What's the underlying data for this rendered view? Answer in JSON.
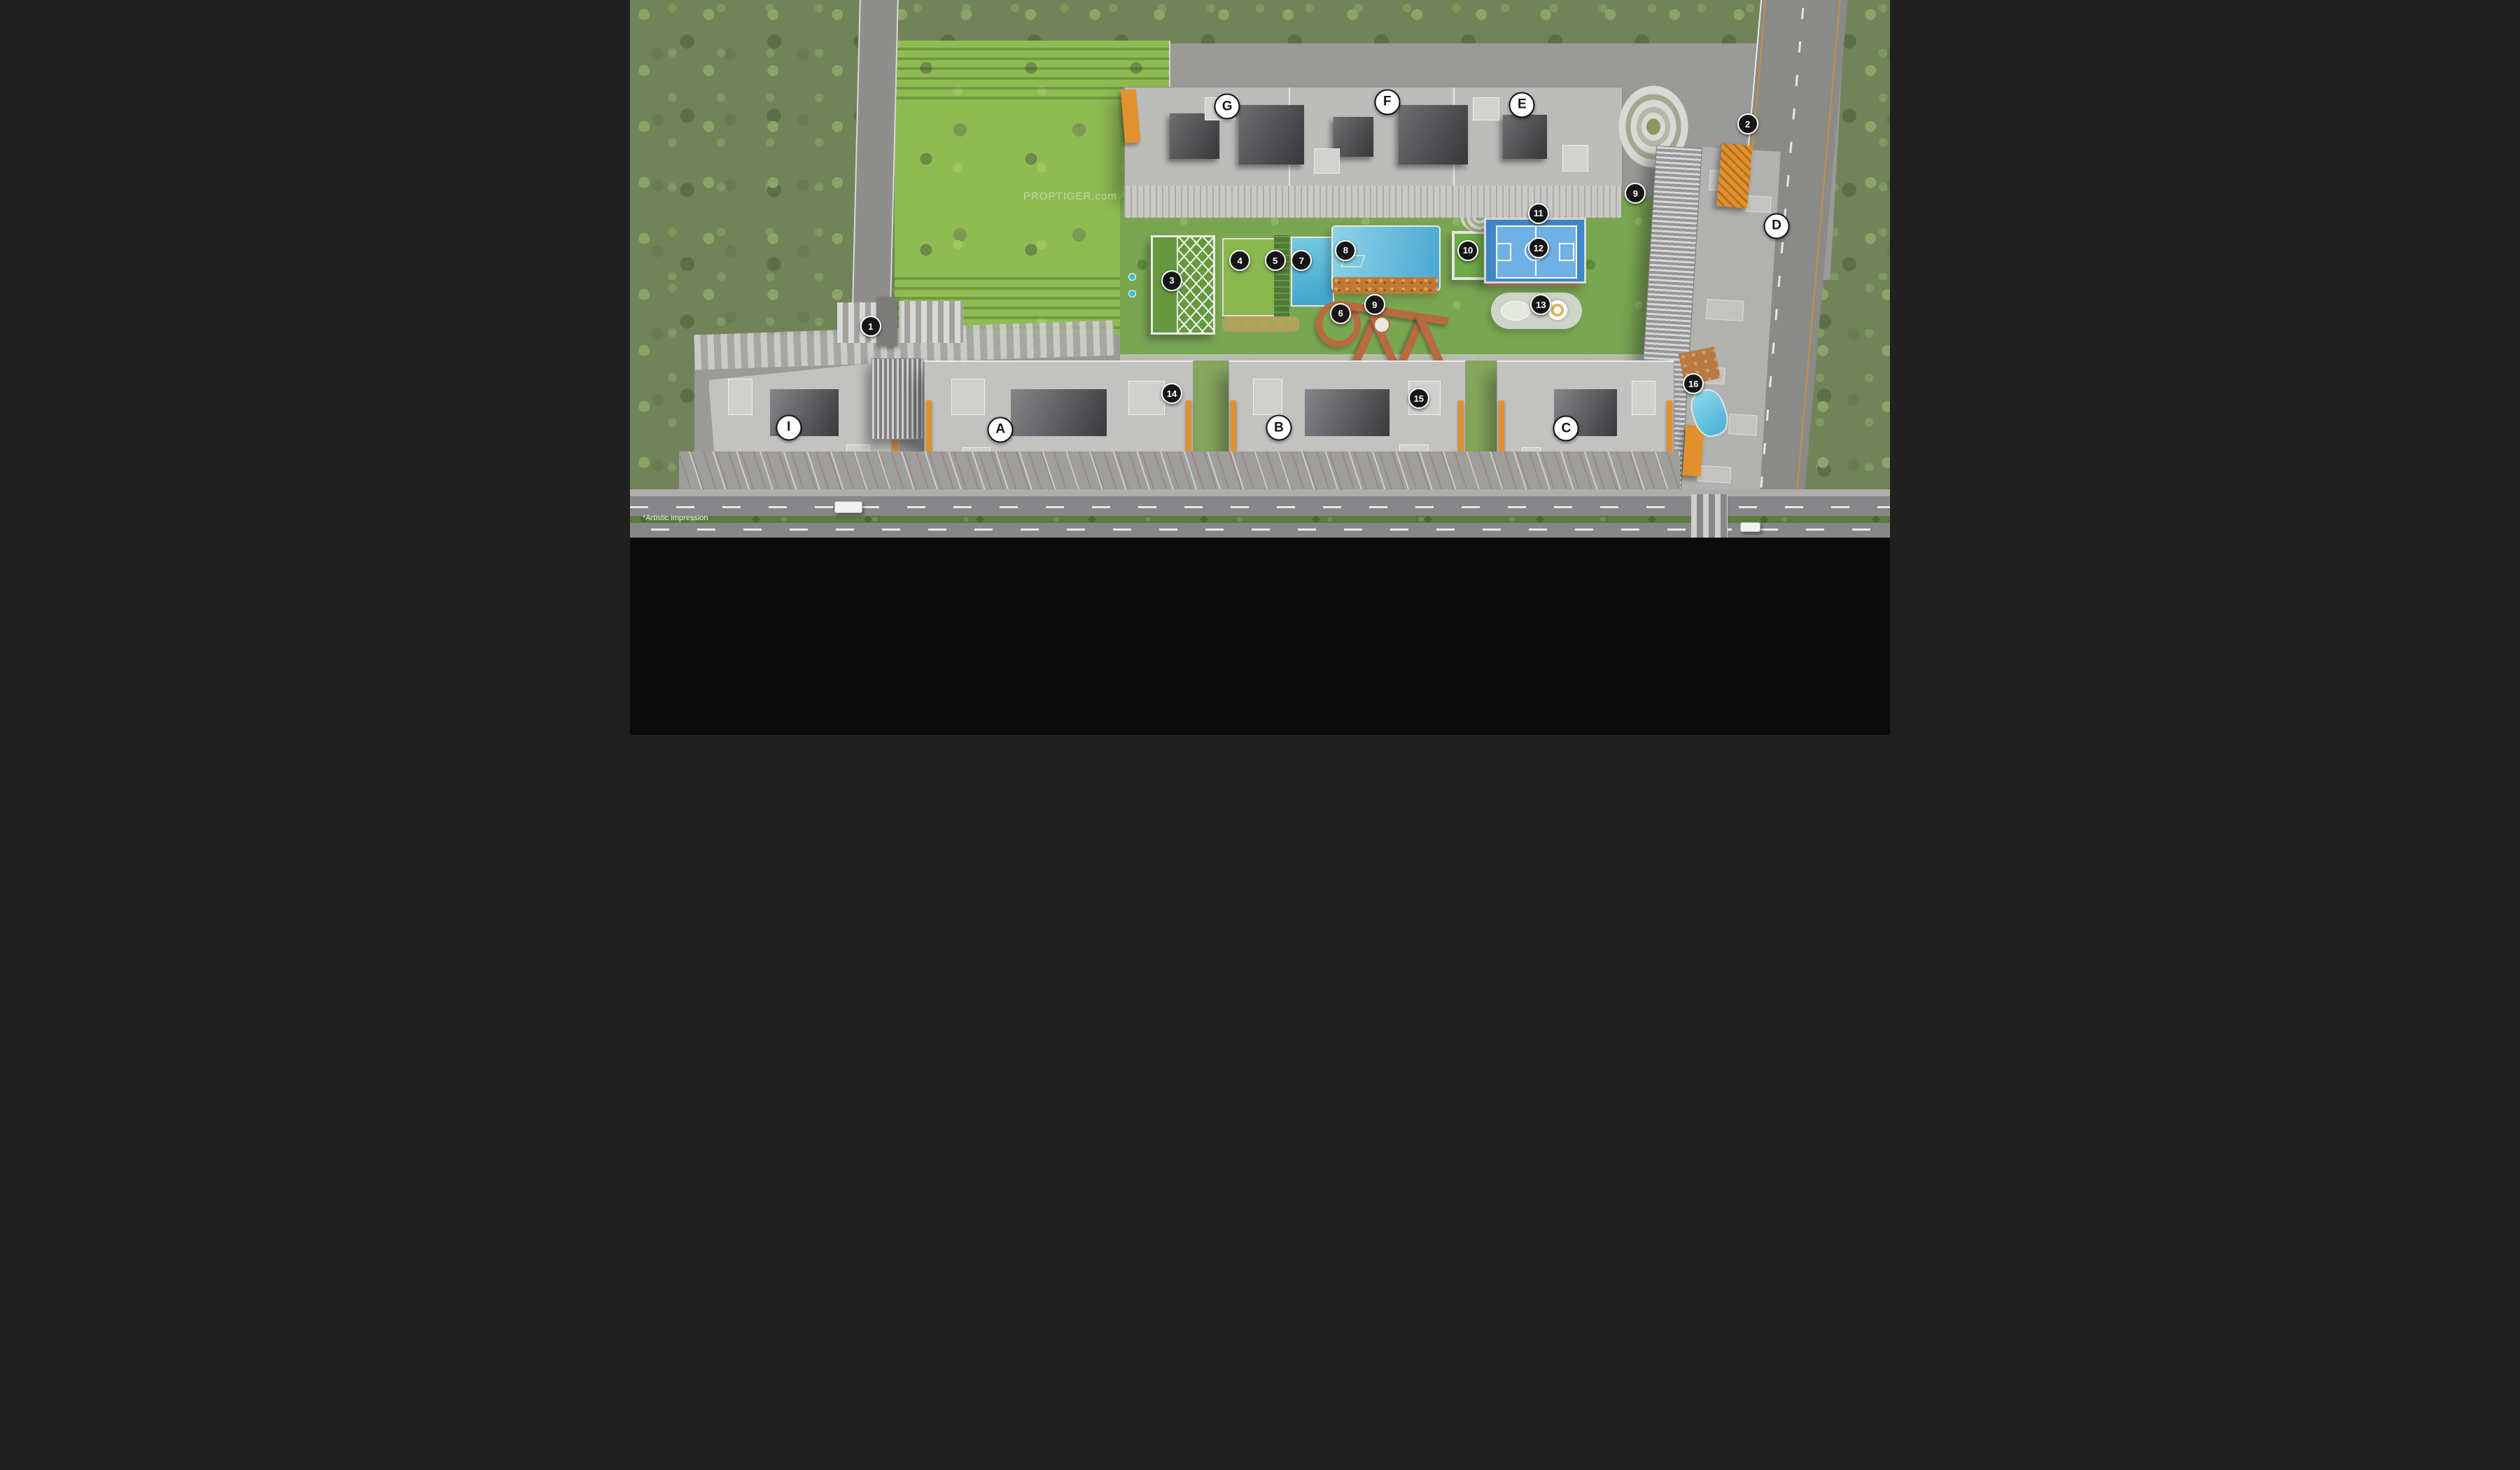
{
  "watermark": "PROPTIGER.com",
  "artistic_note": "*Artistic impression",
  "colors": {
    "legend_bg": "#0b0b0b",
    "accent_orange": "#e0912e",
    "boardwalk_rust": "#b96a3e",
    "pool_blue": "#49a8d2",
    "court_blue": "#3e86c8",
    "lawn_green": "#8fbc52",
    "amenity_green": "#79a651",
    "tree_green": "#72835a",
    "building_gray": "#c2c2c0",
    "road_gray": "#8a8a88",
    "marker_bg": "#161616",
    "marker_text": "#ffffff",
    "building_label_bg": "#ffffff",
    "building_label_text": "#141414"
  },
  "legend": {
    "title": "LEGENDS",
    "columns": [
      [
        {
          "num": "1",
          "lines": [
            "Designer Entry Gate (West)"
          ]
        },
        {
          "num": "2",
          "lines": [
            "Designer Entrance Gate (East)"
          ]
        },
        {
          "num": "3",
          "lines": [
            "Clubhouse - Multipurpose Hall (GF)",
            "Crèche (FF)"
          ]
        },
        {
          "num": "4",
          "lines": [
            "Open Lawn"
          ]
        },
        {
          "num": "5",
          "lines": [
            "Main Garden"
          ]
        }
      ],
      [
        {
          "num": "6",
          "lines": [
            "Connected Boardwalk"
          ]
        },
        {
          "num": "7",
          "lines": [
            "Leisure Pool"
          ]
        },
        {
          "num": "8",
          "lines": [
            "Main Swimming Pool"
          ]
        },
        {
          "num": "9",
          "lines": [
            "Well-being Garden"
          ]
        },
        {
          "num": "10",
          "lines": [
            "Feature Pavilion with",
            "Wooden Deck"
          ]
        }
      ],
      [
        {
          "num": "11",
          "lines": [
            "Step Amphitheatre"
          ]
        },
        {
          "num": "12",
          "lines": [
            "Multi-sport Court"
          ]
        },
        {
          "num": "13",
          "lines": [
            "Kids' Play Area"
          ]
        },
        {
          "num": "14",
          "lines": [
            "Terrace Garden",
            "- Viewing Terrace with Fragrant Garden",
            "- Family Seat & BBQ Area"
          ]
        }
      ],
      [
        {
          "num": "15",
          "lines": [
            "Terrace Garden",
            "- Viewing Terrace with Fragrant Garden",
            "- Family Seat & BBQ Area"
          ]
        },
        {
          "num": "16",
          "lines": [
            "Terrace Garden",
            "- Party Terrace",
            "- Tea Pavilion"
          ]
        }
      ]
    ]
  },
  "plan": {
    "markers": [
      {
        "num": "1",
        "x": 19.1,
        "y": 60.7
      },
      {
        "num": "2",
        "x": 88.7,
        "y": 23.1
      },
      {
        "num": "3",
        "x": 43.0,
        "y": 52.2
      },
      {
        "num": "4",
        "x": 48.4,
        "y": 48.5
      },
      {
        "num": "5",
        "x": 51.2,
        "y": 48.5
      },
      {
        "num": "6",
        "x": 56.4,
        "y": 58.3
      },
      {
        "num": "7",
        "x": 53.3,
        "y": 48.5
      },
      {
        "num": "8",
        "x": 56.8,
        "y": 46.6
      },
      {
        "num": "9",
        "x": 59.1,
        "y": 56.7
      },
      {
        "num": "9",
        "x": 79.8,
        "y": 36.0
      },
      {
        "num": "10",
        "x": 66.5,
        "y": 46.6
      },
      {
        "num": "11",
        "x": 72.1,
        "y": 39.7
      },
      {
        "num": "12",
        "x": 72.1,
        "y": 46.1
      },
      {
        "num": "13",
        "x": 72.3,
        "y": 56.7
      },
      {
        "num": "14",
        "x": 43.0,
        "y": 73.2
      },
      {
        "num": "15",
        "x": 62.6,
        "y": 74.1
      },
      {
        "num": "16",
        "x": 84.4,
        "y": 71.4
      }
    ],
    "buildings": [
      {
        "id": "G",
        "x": 47.4,
        "y": 19.8
      },
      {
        "id": "F",
        "x": 60.1,
        "y": 19.0
      },
      {
        "id": "E",
        "x": 70.8,
        "y": 19.5
      },
      {
        "id": "D",
        "x": 91.0,
        "y": 42.0
      },
      {
        "id": "I",
        "x": 12.6,
        "y": 79.5
      },
      {
        "id": "A",
        "x": 29.4,
        "y": 79.9
      },
      {
        "id": "B",
        "x": 51.5,
        "y": 79.6
      },
      {
        "id": "C",
        "x": 74.3,
        "y": 79.7
      }
    ]
  }
}
